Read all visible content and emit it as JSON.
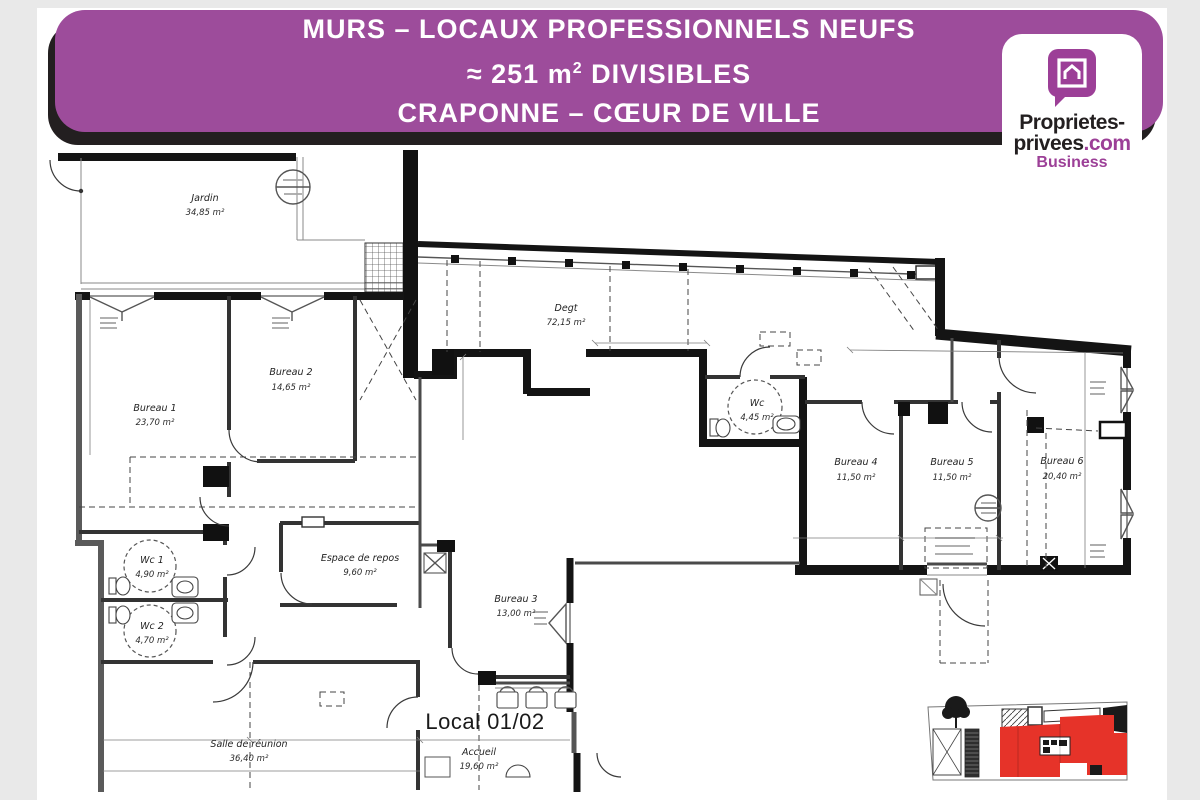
{
  "colors": {
    "page_bg": "#e9e9e9",
    "sheet_bg": "#ffffff",
    "banner_purple": "#9d4c9b",
    "banner_shadow": "#231f20",
    "banner_text": "#ffffff",
    "logo_purple": "#9c3f97",
    "logo_black": "#231f20",
    "plan_line": "#141414",
    "minimap_highlight": "#e63329"
  },
  "banner": {
    "line1": "MURS – LOCAUX PROFESSIONNELS NEUFS",
    "line2_prefix": "≈ 251 m",
    "line2_sup": "2",
    "line2_suffix": " DIVISIBLES",
    "line3": "CRAPONNE – CŒUR DE VILLE"
  },
  "logo": {
    "icon": "house-in-speech-bubble-icon",
    "line1": "Proprietes-",
    "line2_black": "privees",
    "line2_purple": ".com",
    "subtitle": "Business"
  },
  "floorplan": {
    "big_label": "Local 01/02",
    "rooms": [
      {
        "name": "Jardin",
        "area": "34,85 m²"
      },
      {
        "name": "Bureau 1",
        "area": "23,70 m²"
      },
      {
        "name": "Bureau 2",
        "area": "14,65 m²"
      },
      {
        "name": "Degt",
        "area": "72,15 m²"
      },
      {
        "name": "Wc",
        "area": "4,45 m²"
      },
      {
        "name": "Bureau 4",
        "area": "11,50 m²"
      },
      {
        "name": "Bureau 5",
        "area": "11,50 m²"
      },
      {
        "name": "Bureau 6",
        "area": "20,40 m²"
      },
      {
        "name": "Wc 1",
        "area": "4,90 m²"
      },
      {
        "name": "Wc 2",
        "area": "4,70 m²"
      },
      {
        "name": "Espace de repos",
        "area": "9,60 m²"
      },
      {
        "name": "Bureau 3",
        "area": "13,00 m²"
      },
      {
        "name": "Salle de réunion",
        "area": "36,40 m²"
      },
      {
        "name": "Accueil",
        "area": "19,60 m²"
      }
    ]
  }
}
